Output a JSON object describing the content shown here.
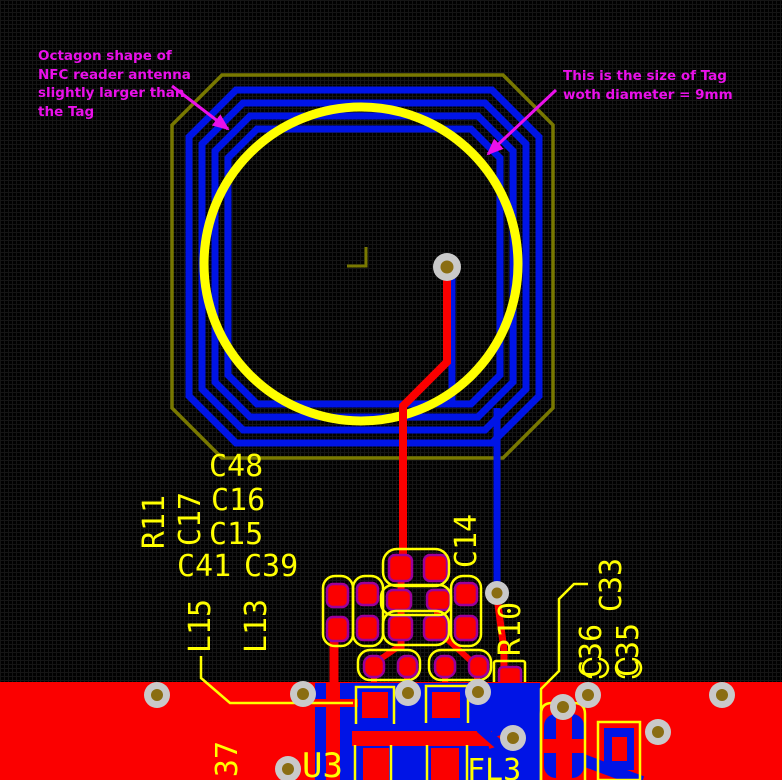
{
  "board": {
    "annotations": {
      "octagon_note": {
        "lines": [
          "Octagon shape of",
          "NFC reader antenna",
          "slightly larger than",
          "the Tag"
        ]
      },
      "tag_note": {
        "lines": [
          "This is the size of Tag",
          "woth diameter = 9mm"
        ]
      }
    },
    "designators": {
      "c48": "C48",
      "c16": "C16",
      "c15": "C15",
      "r11": "R11",
      "c17": "C17",
      "c41": "C41",
      "c39": "C39",
      "l15": "L15",
      "l13": "L13",
      "c14": "C14",
      "r10": "R10",
      "c33": "C33",
      "c36": "C36",
      "c35": "C35",
      "pin37": "37",
      "u3": "U3",
      "fl3": "FL3"
    },
    "colors": {
      "top_copper": "#fb0000",
      "bottom_copper": "#0014e6",
      "silkscreen": "#ffff00",
      "mechanical_outline": "#787800",
      "tag_circle": "#ffff00",
      "annotation_text": "#ea10ea",
      "pad_ring": "#9b009b",
      "via_ring": "#c9c9c9",
      "via_hole": "#8a6d12",
      "background": "#010101"
    }
  }
}
